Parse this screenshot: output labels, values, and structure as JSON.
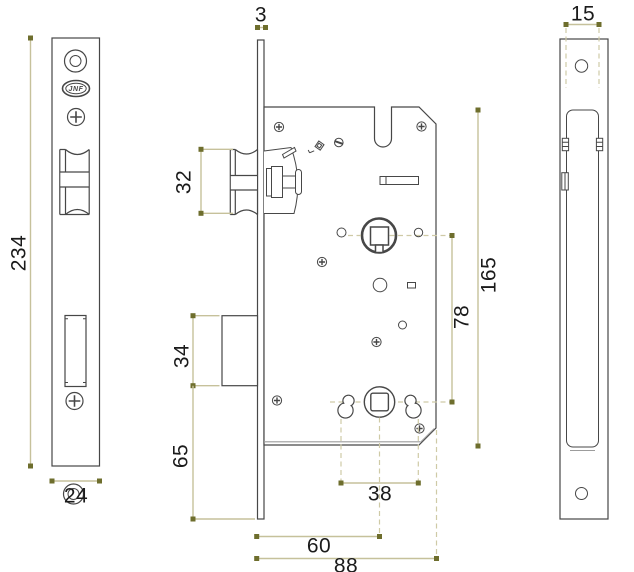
{
  "drawing": {
    "brand": "JNF",
    "dimensions": {
      "front_plate_height": "234",
      "front_plate_width": "24",
      "faceplate_thickness": "3",
      "latch_height": "32",
      "deadbolt_height": "34",
      "lower_section_height": "65",
      "keyhole_spacing": "38",
      "backset": "60",
      "case_depth": "88",
      "axis_distance": "78",
      "case_height": "165",
      "case_width": "15"
    },
    "colors": {
      "line": "#474747",
      "secondary_line": "#9c9c9c",
      "dimension_line": "#c6c19b",
      "dimension_marker": "#6e6e2d",
      "text": "#1b1b1b"
    }
  }
}
